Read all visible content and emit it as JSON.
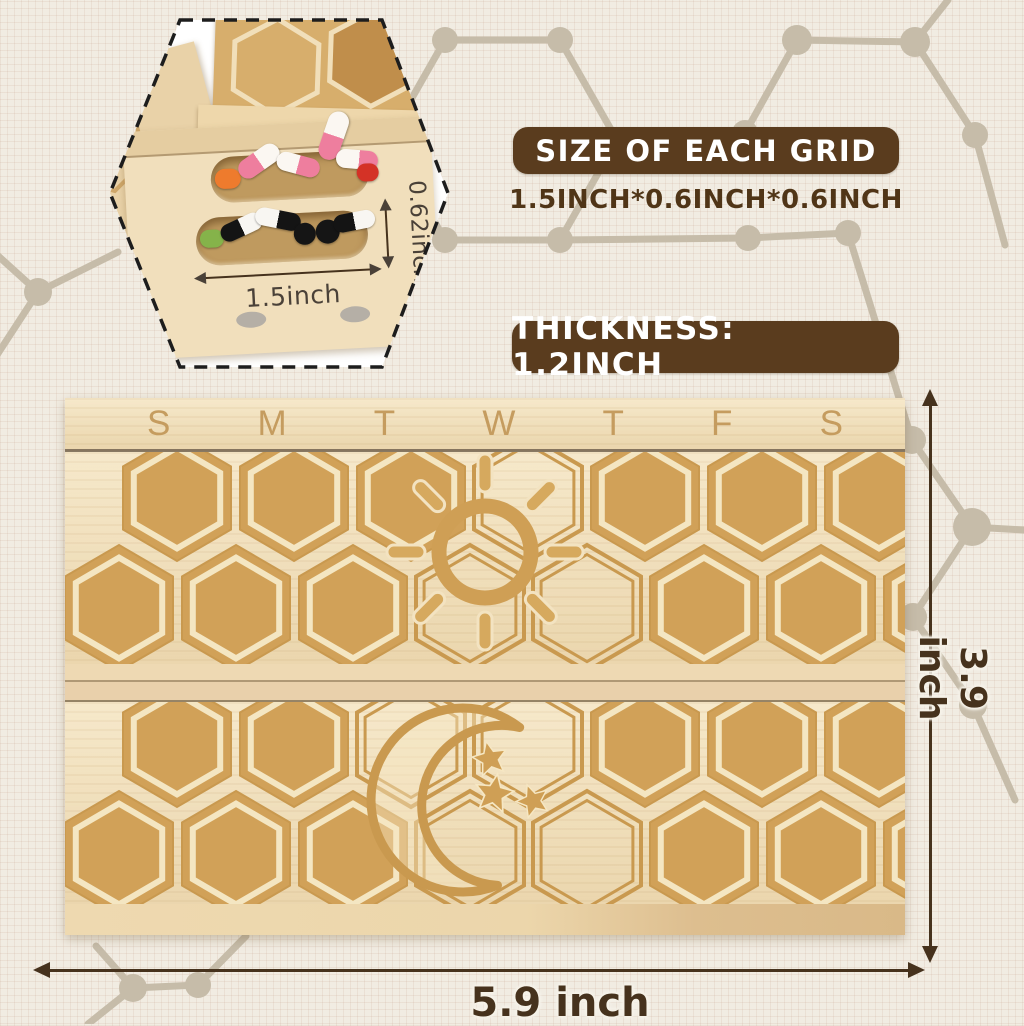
{
  "inset": {
    "grid_width_label": "1.5inch",
    "grid_depth_label": "0.62inch"
  },
  "size_callout": {
    "title": "SIZE OF EACH GRID",
    "value": "1.5INCH*0.6INCH*0.6INCH"
  },
  "thickness_callout": {
    "label": "THICKNESS:  1.2INCH"
  },
  "organizer": {
    "day_labels": [
      "S",
      "M",
      "T",
      "W",
      "T",
      "F",
      "S"
    ]
  },
  "dimensions": {
    "height_label": "3.9 inch",
    "width_label": "5.9 inch"
  },
  "colors": {
    "banner_brown": "#5a3c1e",
    "text_brown": "#503517",
    "dimension_brown": "#46321d",
    "wood_light": "#f1dfb9",
    "engraving_tan": "#d1a158",
    "engraving_line": "#c9994f",
    "background": "#f1ece2",
    "network_tan": "#c6bca9"
  }
}
